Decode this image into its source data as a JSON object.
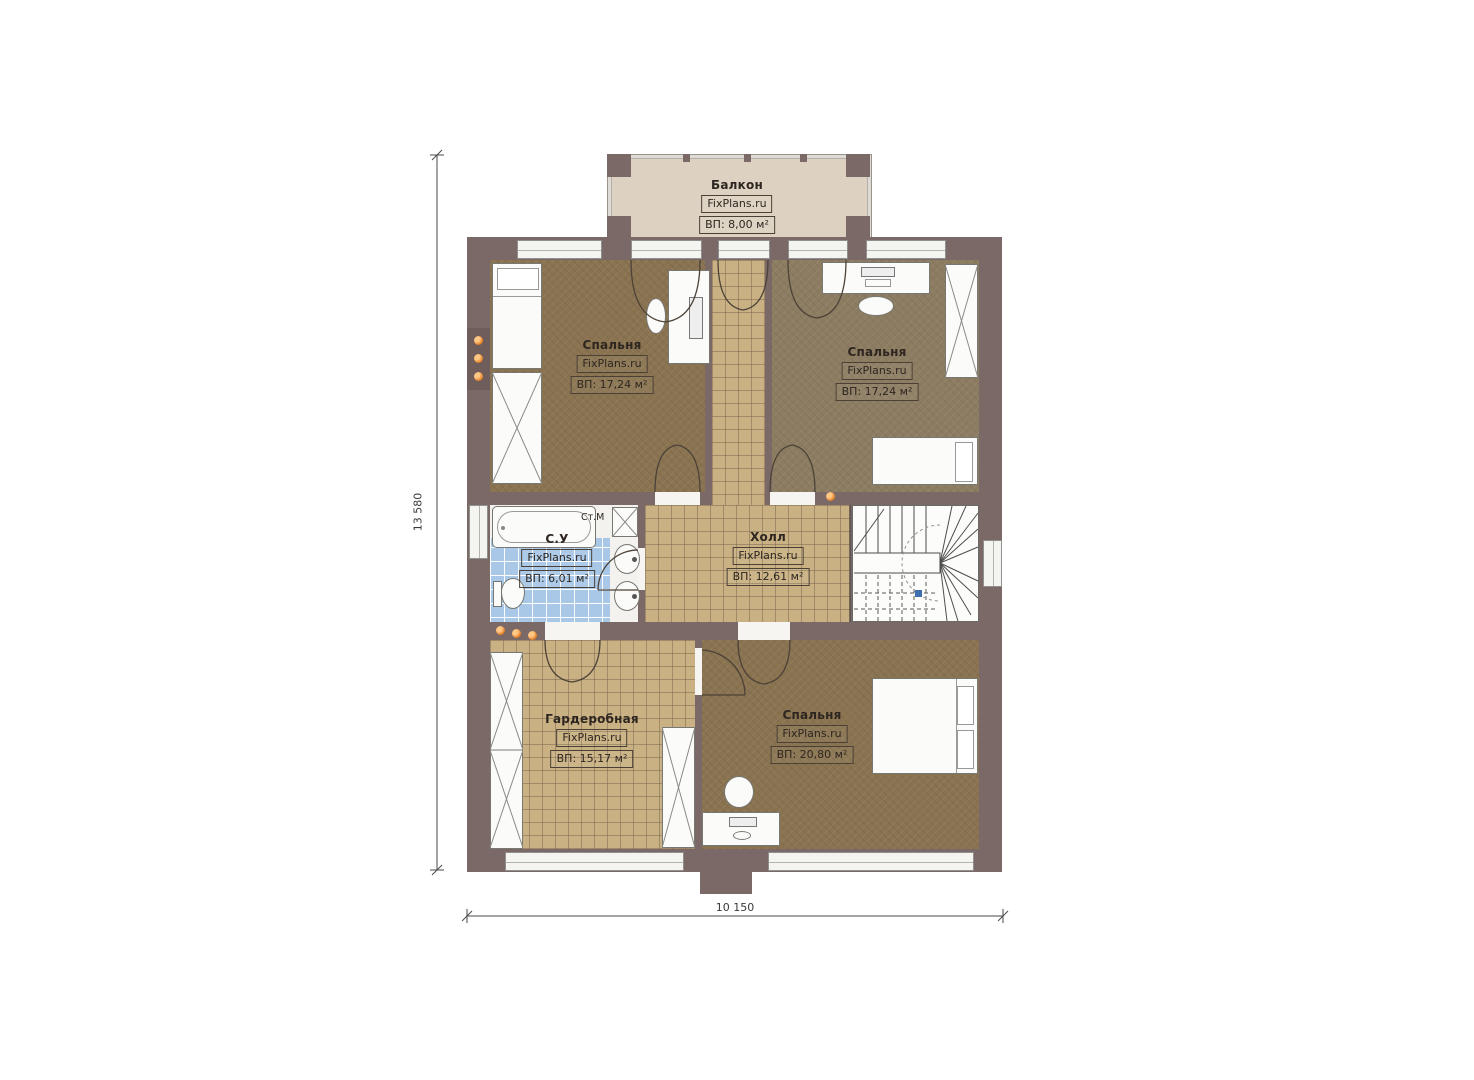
{
  "plan": {
    "brand": "FixPlans.ru",
    "dimensions": {
      "height_total": "13 580",
      "width_total": "10 150"
    },
    "rooms": {
      "balcony": {
        "name": "Балкон",
        "brand": "FixPlans.ru",
        "area": "ВП: 8,00 м²"
      },
      "bedroom_tl": {
        "name": "Спальня",
        "brand": "FixPlans.ru",
        "area": "ВП: 17,24 м²"
      },
      "bedroom_tr": {
        "name": "Спальня",
        "brand": "FixPlans.ru",
        "area": "ВП: 17,24 м²"
      },
      "bathroom": {
        "name": "С.У",
        "brand": "FixPlans.ru",
        "area": "ВП: 6,01 м²"
      },
      "hall": {
        "name": "Холл",
        "brand": "FixPlans.ru",
        "area": "ВП: 12,61 м²"
      },
      "wardrobe": {
        "name": "Гардеробная",
        "brand": "FixPlans.ru",
        "area": "ВП: 15,17 м²"
      },
      "bedroom_b": {
        "name": "Спальня",
        "brand": "FixPlans.ru",
        "area": "ВП: 20,80 м²"
      }
    },
    "annotations": {
      "washing_machine": "Ст.М"
    },
    "colors": {
      "wall": "#7b6967",
      "balcony_floor": "#ddd2c1",
      "carpet": "#8a7350",
      "carpet_gray": "#8c7c61",
      "tile": "#c9b183",
      "bath_tile": "#a9c8e7",
      "accent_orange": "#e2771e"
    }
  }
}
